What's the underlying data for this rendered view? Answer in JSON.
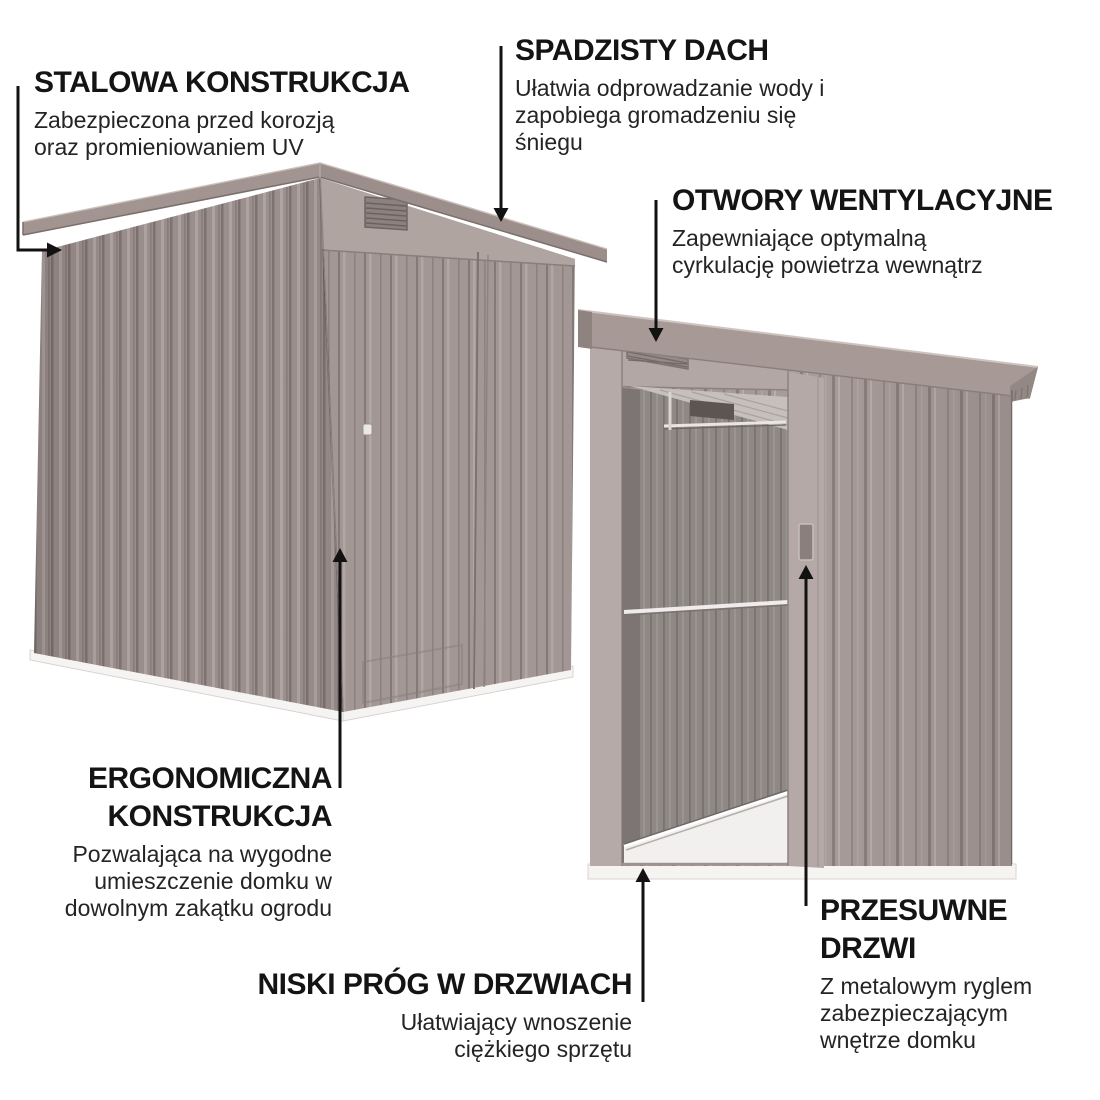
{
  "features": [
    {
      "id": "steel",
      "title": "STALOWA KONSTRUKCJA",
      "desc": "Zabezpieczona przed korozją oraz promieniowaniem UV"
    },
    {
      "id": "roof",
      "title": "SPADZISTY DACH",
      "desc": "Ułatwia odprowadzanie wody i zapobiega gromadzeniu się śniegu"
    },
    {
      "id": "vents",
      "title": "OTWORY WENTYLACYJNE",
      "desc": "Zapewniające optymalną cyrkulację powietrza wewnątrz"
    },
    {
      "id": "ergonomic",
      "title": "ERGONOMICZNA KONSTRUKCJA",
      "desc": "Pozwalająca na wygodne umieszczenie domku w dowolnym zakątku ogrodu"
    },
    {
      "id": "threshold",
      "title": "NISKI PRÓG W DRZWIACH",
      "desc": "Ułatwiający wnoszenie ciężkiego sprzętu"
    },
    {
      "id": "door",
      "title": "PRZESUWNE DRZWI",
      "desc": "Z metalowym ryglem zabezpieczającym wnętrze domku"
    }
  ],
  "illustration": {
    "left_shed_label": "widok zewnętrzny domku ogrodowego",
    "right_shed_label": "domek z otwartymi drzwiami przesuwnymi"
  },
  "colors": {
    "text": "#1c1c1c",
    "arrow": "#121212",
    "shed_wall": "#a39794",
    "shed_roof": "#9c8e8b",
    "interior": "#8e8885",
    "floor": "#f2f0ee",
    "base_strip": "#f6f4f3",
    "background": "#ffffff"
  }
}
